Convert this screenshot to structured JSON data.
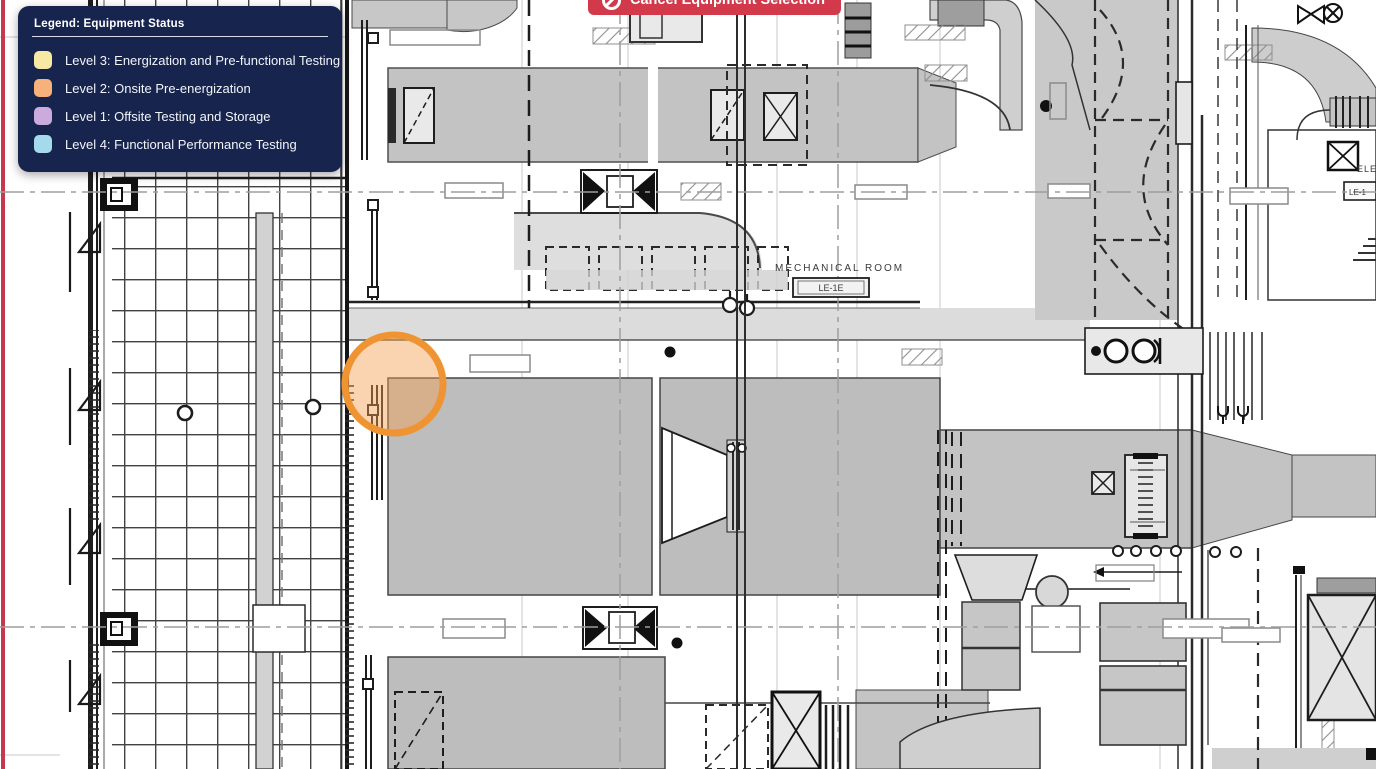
{
  "toolbar": {
    "cancel_button_label": "Cancel Equipment Selection",
    "cancel_button_color": "#d2394a",
    "cancel_icon": "no-entry-circle"
  },
  "legend": {
    "title": "Legend: Equipment Status",
    "background_color": "#17244d",
    "items": [
      {
        "label": "Level 3: Energization and Pre-functional Testing",
        "color": "#f7e9a4"
      },
      {
        "label": "Level 2: Onsite Pre-energization",
        "color": "#f7b27c"
      },
      {
        "label": "Level 1: Offsite Testing and Storage",
        "color": "#cbaade"
      },
      {
        "label": "Level 4: Functional Performance Testing",
        "color": "#a5daec"
      }
    ]
  },
  "floor_plan": {
    "labels": {
      "mechanical_room": "MECHANICAL ROOM",
      "equipment_tag": "LE-1E",
      "elevator_partial": "ELE",
      "right_tag_partial": "LE-1"
    },
    "selection_highlight": {
      "stroke_color": "#ef9433",
      "fill_color": "rgba(243,160,82,0.45)"
    }
  }
}
